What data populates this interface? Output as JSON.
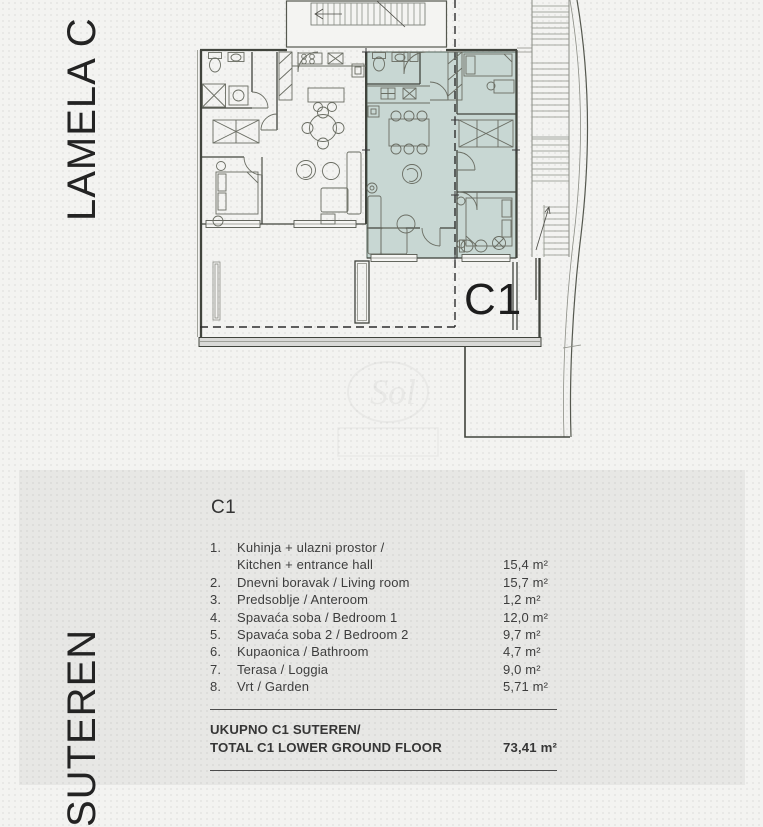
{
  "page": {
    "accent_teal": "#c8d7d3",
    "line_color": "#41443d",
    "background": "#f3f3f1",
    "panel_bg": "#e9e9e7"
  },
  "sidebar": {
    "top_label": "LAMELA C",
    "bottom_label": "SUTEREN"
  },
  "plan": {
    "unit_label": "C1",
    "watermark": "Sol"
  },
  "panel": {
    "title": "C1",
    "rows": [
      {
        "num": "1.",
        "lines": [
          "Kuhinja + ulazni prostor /",
          "Kitchen + entrance hall"
        ],
        "area": "15,4 m²"
      },
      {
        "num": "2.",
        "lines": [
          "Dnevni boravak / Living room"
        ],
        "area": "15,7 m²"
      },
      {
        "num": "3.",
        "lines": [
          "Predsoblje / Anteroom"
        ],
        "area": "1,2 m²"
      },
      {
        "num": "4.",
        "lines": [
          "Spavaća soba / Bedroom 1"
        ],
        "area": "12,0 m²"
      },
      {
        "num": "5.",
        "lines": [
          "Spavaća soba 2 / Bedroom 2"
        ],
        "area": "9,7 m²"
      },
      {
        "num": "6.",
        "lines": [
          "Kupaonica / Bathroom"
        ],
        "area": "4,7 m²"
      },
      {
        "num": "7.",
        "lines": [
          "Terasa / Loggia"
        ],
        "area": "9,0 m²"
      },
      {
        "num": "8.",
        "lines": [
          "Vrt / Garden"
        ],
        "area": "5,71 m²"
      }
    ],
    "total": {
      "label_line1": "UKUPNO C1 SUTEREN/",
      "label_line2": "TOTAL C1 LOWER GROUND FLOOR",
      "area": "73,41 m²"
    }
  }
}
